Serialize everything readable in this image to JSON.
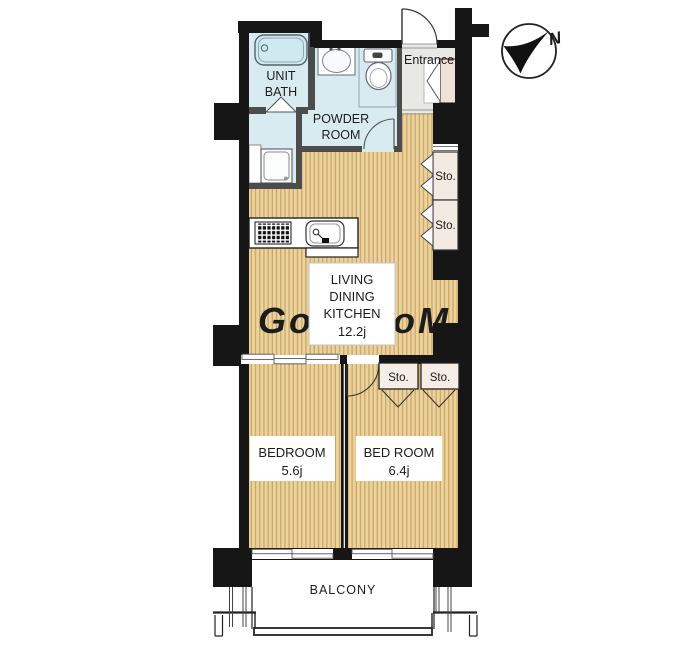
{
  "compass": {
    "north_label": "N"
  },
  "rooms": {
    "unit_bath": {
      "label_line1": "UNIT",
      "label_line2": "BATH"
    },
    "powder_room": {
      "label_line1": "POWDER",
      "label_line2": "ROOM"
    },
    "entrance": {
      "label": "Entrance"
    },
    "living_dining_kitchen": {
      "label_line1": "LIVING",
      "label_line2": "DINING",
      "label_line3": "KITCHEN",
      "size": "12.2j"
    },
    "bedroom_left": {
      "label": "BEDROOM",
      "size": "5.6j"
    },
    "bedroom_right": {
      "label": "BED ROOM",
      "size": "6.4j"
    },
    "balcony": {
      "label": "BALCONY"
    }
  },
  "storage": {
    "ldk_sto_upper": "Sto.",
    "ldk_sto_lower": "Sto.",
    "bedroom_sto_left": "Sto.",
    "bedroom_sto_right": "Sto."
  },
  "watermark": "GooRooM",
  "colors": {
    "wall": "#161616",
    "wood_floor": "#ecd29b",
    "wood_stripe": "#c9a76c",
    "sanitary_floor": "#d8ebf1",
    "entrance_floor": "#e8e8e4",
    "closet_fill": "#f3eae1",
    "shoe_cabinet_fill": "#f1e1d4"
  }
}
